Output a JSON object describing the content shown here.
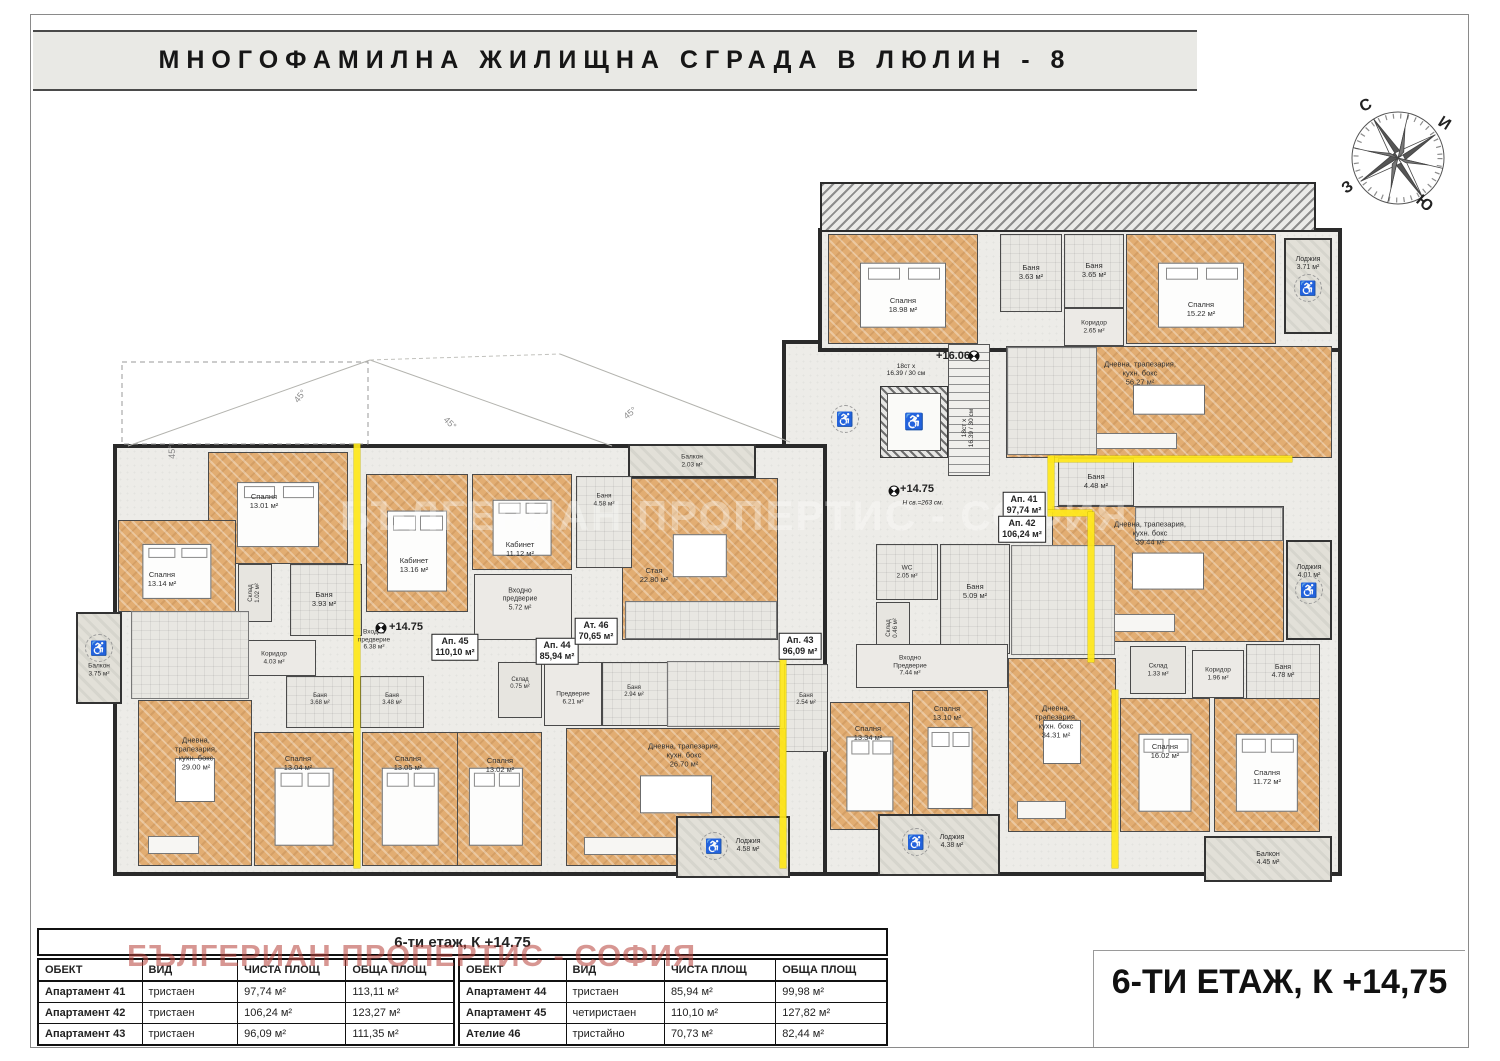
{
  "title": "МНОГОФАМИЛНА ЖИЛИЩНА СГРАДА В ЛЮЛИН - 8",
  "floor_title": "6-ТИ ЕТАЖ, К +14,75",
  "watermark": "БЪЛГЕРИАН ПРОПЕРТИС - СОФИЯ",
  "compass": {
    "n": "С",
    "e": "И",
    "w": "З",
    "s": "Ю"
  },
  "tables": {
    "merged_header": "6-ти етаж, К +14.75",
    "columns": [
      "ОБЕКТ",
      "ВИД",
      "ЧИСТА ПЛОЩ",
      "ОБЩА ПЛОЩ"
    ],
    "left_rows": [
      [
        "Апартамент 41",
        "тристаен",
        "97,74 м²",
        "113,11 м²"
      ],
      [
        "Апартамент 42",
        "тристаен",
        "106,24 м²",
        "123,27 м²"
      ],
      [
        "Апартамент 43",
        "тристаен",
        "96,09 м²",
        "111,35 м²"
      ]
    ],
    "right_rows": [
      [
        "Апартамент 44",
        "тристаен",
        "85,94 м²",
        "99,98 м²"
      ],
      [
        "Апартамент 45",
        "четиристаен",
        "110,10 м²",
        "127,82 м²"
      ],
      [
        "Ателие 46",
        "тристайно",
        "70,73 м²",
        "82,44 м²"
      ]
    ]
  },
  "plan": {
    "apartment_tags": [
      {
        "name": "Ап. 41",
        "area": "97,74 м²",
        "x": 1024,
        "y": 505
      },
      {
        "name": "Ап. 42",
        "area": "106,24 м²",
        "x": 1022,
        "y": 529
      },
      {
        "name": "Ап. 43",
        "area": "96,09 м²",
        "x": 800,
        "y": 646
      },
      {
        "name": "Ап. 45",
        "area": "110,10 м²",
        "x": 455,
        "y": 647
      },
      {
        "name": "Ап. 44",
        "area": "85,94 м²",
        "x": 557,
        "y": 651
      },
      {
        "name": "Ат. 46",
        "area": "70,65 м²",
        "x": 596,
        "y": 631
      }
    ],
    "rooms": [
      {
        "n": "Спалня",
        "a": "18.98 м²",
        "t": "bedroom",
        "x": 828,
        "y": 234,
        "w": 150,
        "h": 110,
        "ly": 306
      },
      {
        "n": "Баня",
        "a": "3.63 м²",
        "t": "bath",
        "x": 1000,
        "y": 234,
        "w": 62,
        "h": 78
      },
      {
        "n": "Баня",
        "a": "3.65 м²",
        "t": "bath",
        "x": 1064,
        "y": 234,
        "w": 60,
        "h": 74
      },
      {
        "n": "Коридор",
        "a": "2.65 м²",
        "t": "corridor",
        "x": 1064,
        "y": 308,
        "w": 60,
        "h": 38,
        "fs": 6.5
      },
      {
        "n": "Спалня",
        "a": "15.22 м²",
        "t": "bedroom",
        "x": 1126,
        "y": 234,
        "w": 150,
        "h": 110,
        "ly": 310
      },
      {
        "n": "Лоджия",
        "a": "3.71 м²",
        "t": "loggia",
        "x": 1284,
        "y": 238,
        "w": 48,
        "h": 96,
        "fs": 7,
        "ly": 264
      },
      {
        "n": "Дневна, трапезария,\nкухн. бокс",
        "a": "56.27 м²",
        "t": "living",
        "x": 1006,
        "y": 346,
        "w": 326,
        "h": 112,
        "lx": 1140,
        "ly": 374
      },
      {
        "t": "kitchen",
        "x": 1008,
        "y": 348,
        "w": 88,
        "h": 106
      },
      {
        "n": "Баня",
        "a": "4.48 м²",
        "t": "bath",
        "x": 1058,
        "y": 458,
        "w": 76,
        "h": 48
      },
      {
        "n": "Дневна, трапезария,\nкухн. бокс",
        "a": "39.44 м²",
        "t": "living",
        "x": 1052,
        "y": 506,
        "w": 232,
        "h": 136,
        "lx": 1150,
        "ly": 534
      },
      {
        "t": "kitchen",
        "x": 1136,
        "y": 508,
        "w": 146,
        "h": 32
      },
      {
        "n": "Лоджия",
        "a": "4.01 м²",
        "t": "loggia",
        "x": 1286,
        "y": 540,
        "w": 46,
        "h": 100,
        "fs": 7,
        "ly": 572
      },
      {
        "n": "Склад",
        "a": "1.33 м²",
        "t": "storage",
        "x": 1130,
        "y": 646,
        "w": 56,
        "h": 48,
        "fs": 6.5
      },
      {
        "n": "Коридор",
        "a": "1.96 м²",
        "t": "corridor",
        "x": 1192,
        "y": 650,
        "w": 52,
        "h": 48,
        "fs": 6.5
      },
      {
        "n": "Баня",
        "a": "4.78 м²",
        "t": "bath",
        "x": 1246,
        "y": 644,
        "w": 74,
        "h": 56,
        "fs": 7
      },
      {
        "n": "Спалня",
        "a": "16.02 м²",
        "t": "bedroom",
        "x": 1120,
        "y": 698,
        "w": 90,
        "h": 134,
        "ly": 752
      },
      {
        "n": "Спалня",
        "a": "11.72 м²",
        "t": "bedroom",
        "x": 1214,
        "y": 698,
        "w": 106,
        "h": 134,
        "lx": 1267,
        "ly": 778
      },
      {
        "n": "Балкон",
        "a": "4.45 м²",
        "t": "balcony",
        "x": 1204,
        "y": 836,
        "w": 128,
        "h": 46,
        "fs": 7
      },
      {
        "n": "WC",
        "a": "2.05 м²",
        "t": "bath",
        "x": 876,
        "y": 544,
        "w": 62,
        "h": 56,
        "fs": 6.5
      },
      {
        "n": "Склад",
        "a": "0.46 м²",
        "t": "storage",
        "x": 876,
        "y": 602,
        "w": 34,
        "h": 52,
        "fs": 6,
        "rot": -90
      },
      {
        "n": "Баня",
        "a": "5.09 м²",
        "t": "bath",
        "x": 940,
        "y": 544,
        "w": 70,
        "h": 110,
        "ly": 592
      },
      {
        "t": "kitchen",
        "x": 1012,
        "y": 546,
        "w": 102,
        "h": 108
      },
      {
        "n": "Входно\nПредверие",
        "a": "7.44 м²",
        "t": "hall",
        "x": 856,
        "y": 644,
        "w": 152,
        "h": 44,
        "fs": 6.5,
        "lx": 910,
        "ly": 666
      },
      {
        "n": "Дневна,\nтрапезария,\nкухн. бокс",
        "a": "34.31 м²",
        "t": "living",
        "x": 1008,
        "y": 658,
        "w": 108,
        "h": 174,
        "lx": 1056,
        "ly": 722
      },
      {
        "n": "Баня",
        "a": "2.54 м²",
        "t": "bath",
        "x": 784,
        "y": 664,
        "w": 44,
        "h": 88,
        "fs": 6,
        "lx": 806,
        "ly": 700
      },
      {
        "n": "Спалня",
        "a": "13.34 м²",
        "t": "bedroom",
        "x": 830,
        "y": 702,
        "w": 80,
        "h": 128,
        "lx": 868,
        "ly": 734
      },
      {
        "n": "Спалня",
        "a": "13.10 м²",
        "t": "bedroom",
        "x": 912,
        "y": 690,
        "w": 76,
        "h": 140,
        "lx": 947,
        "ly": 714
      },
      {
        "n": "Лоджия",
        "a": "4.38 м²",
        "t": "loggia",
        "x": 878,
        "y": 814,
        "w": 122,
        "h": 62,
        "fs": 7,
        "lx": 952,
        "ly": 842
      },
      {
        "n": "Стая",
        "a": "22.80 м²",
        "t": "living",
        "x": 622,
        "y": 478,
        "w": 156,
        "h": 162,
        "lx": 654,
        "ly": 576
      },
      {
        "n": "Балкон",
        "a": "2.03 м²",
        "t": "balcony",
        "x": 628,
        "y": 444,
        "w": 128,
        "h": 34,
        "fs": 6.5
      },
      {
        "n": "Баня",
        "a": "4.58 м²",
        "t": "bath",
        "x": 576,
        "y": 476,
        "w": 56,
        "h": 92,
        "fs": 6.5,
        "ly": 500
      },
      {
        "t": "kitchen",
        "x": 626,
        "y": 602,
        "w": 150,
        "h": 36
      },
      {
        "n": "Входно\nпредверие",
        "a": "5.72 м²",
        "t": "hall",
        "x": 474,
        "y": 574,
        "w": 98,
        "h": 66,
        "fs": 7,
        "lx": 520,
        "ly": 600
      },
      {
        "n": "Кабинет",
        "a": "13.16 м²",
        "t": "bedroom",
        "x": 366,
        "y": 474,
        "w": 102,
        "h": 138,
        "lx": 414,
        "ly": 566
      },
      {
        "n": "Кабинет",
        "a": "11.12 м²",
        "t": "bedroom",
        "x": 472,
        "y": 474,
        "w": 100,
        "h": 96,
        "lx": 520,
        "ly": 550
      },
      {
        "n": "Склад",
        "a": "0.75 м²",
        "t": "storage",
        "x": 498,
        "y": 662,
        "w": 44,
        "h": 56,
        "fs": 6,
        "lx": 520,
        "ly": 684
      },
      {
        "n": "Предверие",
        "a": "6.21 м²",
        "t": "hall",
        "x": 544,
        "y": 662,
        "w": 58,
        "h": 64,
        "fs": 6.5,
        "lx": 573,
        "ly": 698
      },
      {
        "n": "Баня",
        "a": "2.94 м²",
        "t": "bath",
        "x": 602,
        "y": 662,
        "w": 66,
        "h": 64,
        "fs": 6,
        "lx": 634,
        "ly": 692
      },
      {
        "t": "kitchen",
        "x": 668,
        "y": 662,
        "w": 112,
        "h": 64
      },
      {
        "n": "Спалня",
        "a": "13.02 м²",
        "t": "bedroom",
        "x": 450,
        "y": 732,
        "w": 92,
        "h": 134,
        "lx": 500,
        "ly": 766
      },
      {
        "n": "Дневна, трапезария,\nкухн. бокс",
        "a": "26.70 м²",
        "t": "living",
        "x": 566,
        "y": 728,
        "w": 220,
        "h": 138,
        "lx": 684,
        "ly": 756
      },
      {
        "n": "Лоджия",
        "a": "4.58 м²",
        "t": "loggia",
        "x": 676,
        "y": 816,
        "w": 114,
        "h": 62,
        "fs": 7,
        "lx": 748,
        "ly": 846
      },
      {
        "n": "Спалня",
        "a": "13.01 м²",
        "t": "bedroom",
        "x": 208,
        "y": 452,
        "w": 140,
        "h": 112,
        "lx": 264,
        "ly": 502
      },
      {
        "n": "Спалня",
        "a": "13.14 м²",
        "t": "bedroom",
        "x": 118,
        "y": 520,
        "w": 118,
        "h": 92,
        "lx": 162,
        "ly": 580
      },
      {
        "n": "Склад",
        "a": "1.02 м²",
        "t": "storage",
        "x": 238,
        "y": 564,
        "w": 34,
        "h": 58,
        "fs": 6,
        "rot": -90
      },
      {
        "n": "Баня",
        "a": "3.93 м²",
        "t": "bath",
        "x": 290,
        "y": 564,
        "w": 72,
        "h": 72,
        "lx": 324,
        "ly": 600
      },
      {
        "n": "Коридор",
        "a": "4.03 м²",
        "t": "hall",
        "x": 240,
        "y": 640,
        "w": 76,
        "h": 36,
        "fs": 6.5,
        "lx": 274,
        "ly": 658
      },
      {
        "t": "kitchen",
        "x": 132,
        "y": 612,
        "w": 116,
        "h": 86
      },
      {
        "n": "Балкон",
        "a": "3.75 м²",
        "t": "balcony",
        "x": 76,
        "y": 612,
        "w": 46,
        "h": 92,
        "fs": 6.5,
        "ly": 670
      },
      {
        "n": "Дневна,\nтрапезария,\nкухн. бокс",
        "a": "29.00 м²",
        "t": "living",
        "x": 138,
        "y": 700,
        "w": 114,
        "h": 166,
        "lx": 196,
        "ly": 754
      },
      {
        "n": "Спалня",
        "a": "13.04 м²",
        "t": "bedroom",
        "x": 254,
        "y": 732,
        "w": 100,
        "h": 134,
        "lx": 298,
        "ly": 764
      },
      {
        "n": "Спалня",
        "a": "13.05 м²",
        "t": "bedroom",
        "x": 362,
        "y": 732,
        "w": 96,
        "h": 134,
        "lx": 408,
        "ly": 764
      },
      {
        "n": "Баня",
        "a": "3.68 м²",
        "t": "bath",
        "x": 286,
        "y": 676,
        "w": 68,
        "h": 52,
        "fs": 6,
        "lx": 320,
        "ly": 700
      },
      {
        "n": "Баня",
        "a": "3.48 м²",
        "t": "bath",
        "x": 360,
        "y": 676,
        "w": 64,
        "h": 52,
        "fs": 6,
        "lx": 392,
        "ly": 700
      }
    ],
    "free_labels": [
      {
        "n": "Входно\nпредверие",
        "a": "6.38 м²",
        "x": 374,
        "y": 640,
        "fs": 6.5
      }
    ],
    "notes": [
      {
        "t": "+16.06",
        "x": 953,
        "y": 356,
        "c": "level"
      },
      {
        "t": "18ст х\n16.39 / 30 см",
        "x": 906,
        "y": 370,
        "c": "tiny"
      },
      {
        "t": "18ст х\n16.39 / 30 см",
        "x": 968,
        "y": 428,
        "c": "tiny",
        "rot": -90
      },
      {
        "t": "+14.75",
        "x": 917,
        "y": 489,
        "c": "level"
      },
      {
        "t": "Н св.=263 см.",
        "x": 923,
        "y": 503,
        "c": "tiny-i"
      },
      {
        "t": "+14.75",
        "x": 406,
        "y": 627,
        "c": "level"
      },
      {
        "t": "45°",
        "x": 300,
        "y": 396,
        "c": "roof",
        "rot": -52
      },
      {
        "t": "45°",
        "x": 450,
        "y": 423,
        "c": "roof",
        "rot": 44
      },
      {
        "t": "45°",
        "x": 630,
        "y": 413,
        "c": "roof",
        "rot": -40
      },
      {
        "t": "45°",
        "x": 172,
        "y": 452,
        "c": "roof",
        "rot": -90
      }
    ]
  }
}
